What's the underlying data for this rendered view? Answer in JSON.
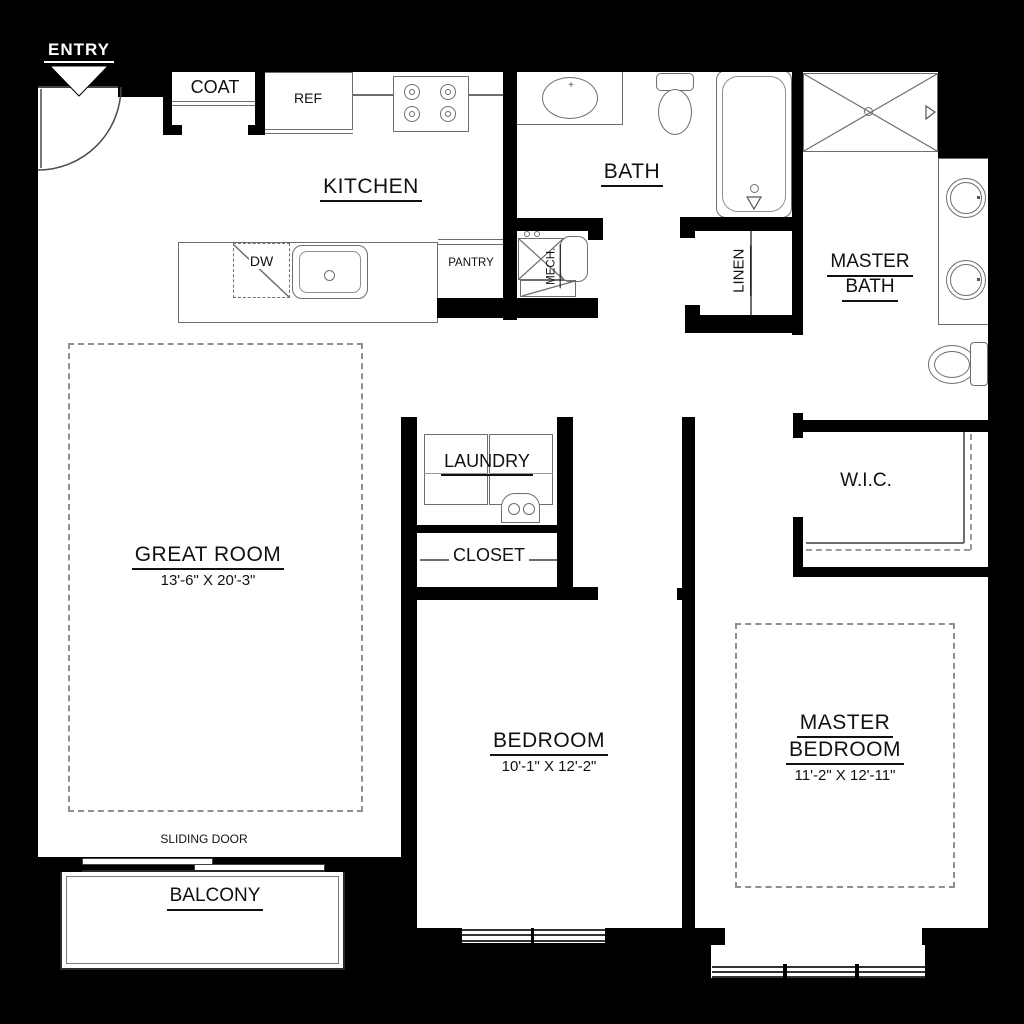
{
  "colors": {
    "background": "#000000",
    "wall": "#000000",
    "floor": "#ffffff",
    "fixture_line": "#6e6e6e",
    "label_text": "#111111",
    "dashed_line": "#8f8f8f",
    "entry_text": "#ffffff"
  },
  "labels": {
    "entry": "ENTRY",
    "coat": "COAT",
    "ref": "REF",
    "kitchen": "KITCHEN",
    "bath": "BATH",
    "master_bath_line1": "MASTER",
    "master_bath_line2": "BATH",
    "dw": "DW",
    "pantry": "PANTRY",
    "mech": "MECH.",
    "linen": "LINEN",
    "laundry": "LAUNDRY",
    "closet": "CLOSET",
    "wic": "W.I.C.",
    "sliding_door": "SLIDING DOOR",
    "balcony": "BALCONY",
    "faucet_mark": "+"
  },
  "rooms": {
    "great_room": {
      "name": "GREAT ROOM",
      "dimensions": "13'-6\" X 20'-3\""
    },
    "bedroom": {
      "name": "BEDROOM",
      "dimensions": "10'-1\" X 12'-2\""
    },
    "master_bedroom": {
      "name_line1": "MASTER",
      "name_line2": "BEDROOM",
      "dimensions": "11'-2\" X 12'-11\""
    }
  }
}
